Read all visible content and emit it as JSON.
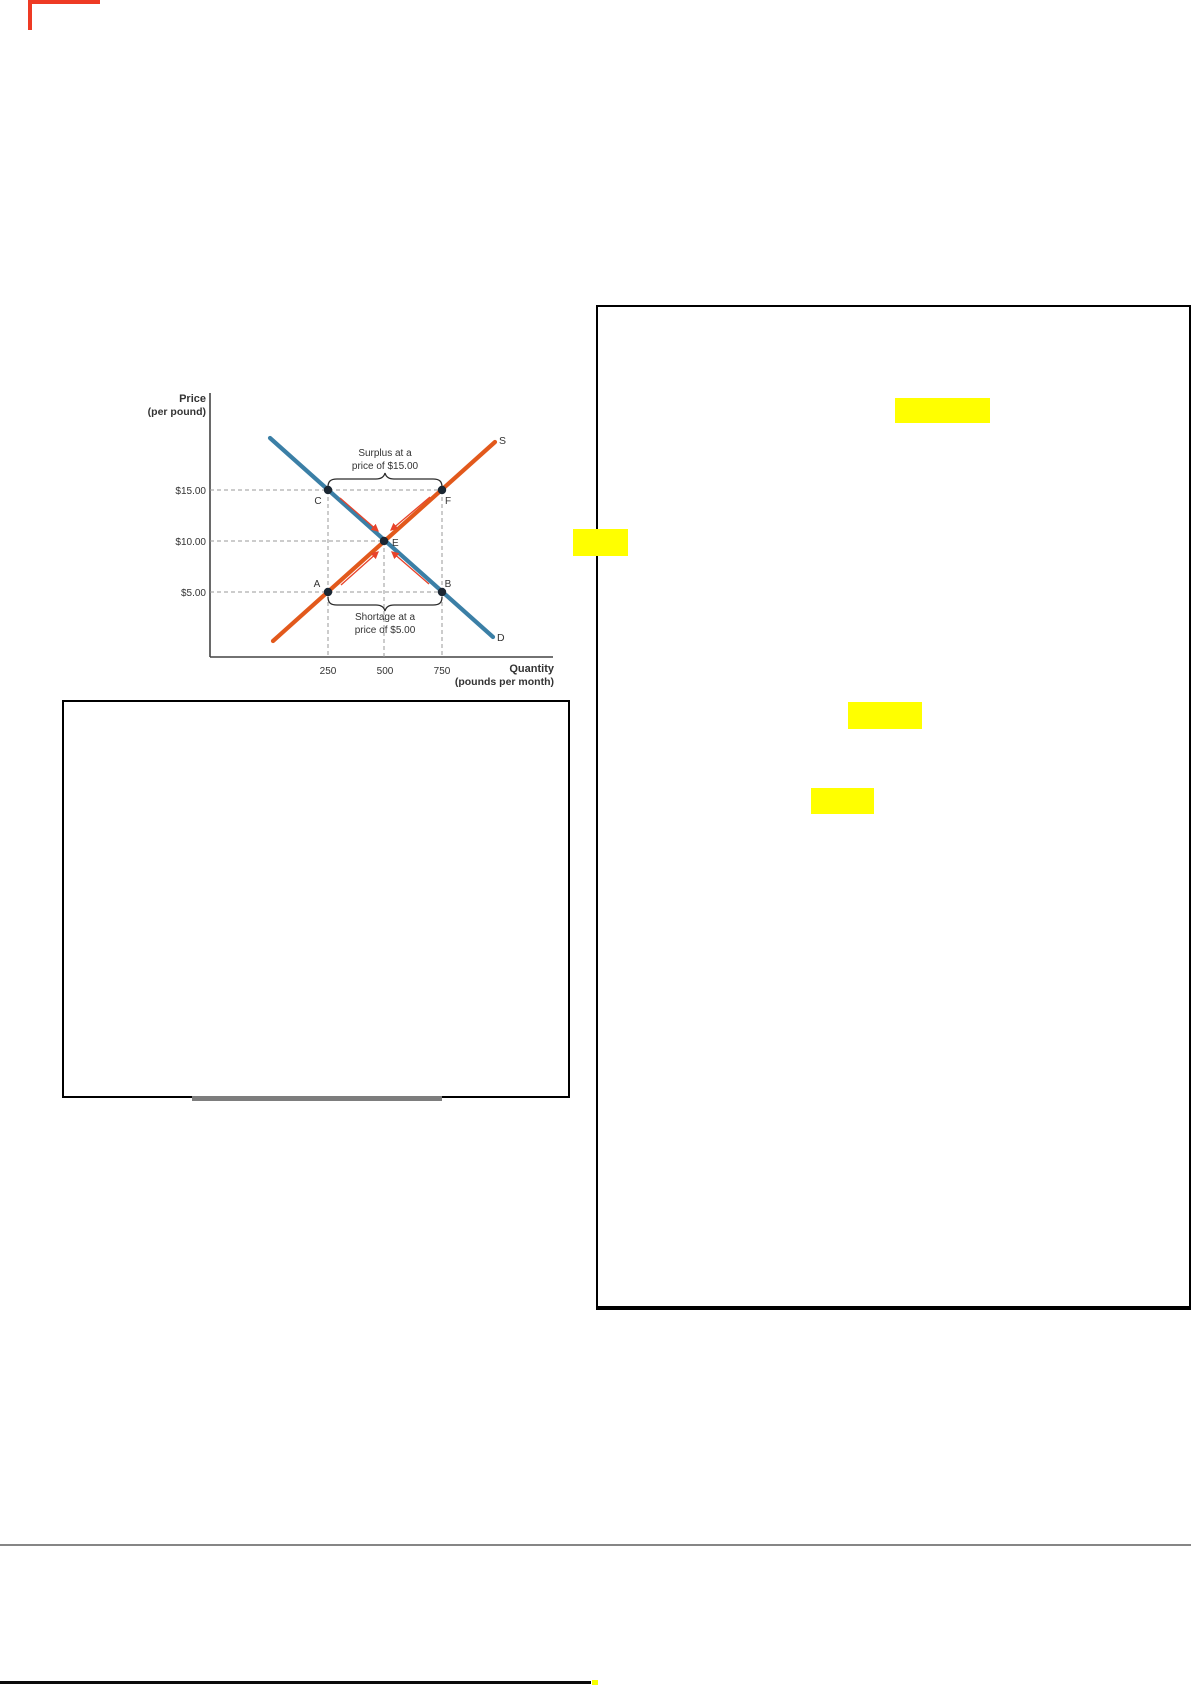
{
  "page": {
    "kind": "scanned economics worksheet page",
    "background": "#ffffff"
  },
  "chart_data": {
    "type": "line",
    "ylabel": "Price (per pound)",
    "ylabel_lines": [
      "Price",
      "(per pound)"
    ],
    "xlabel": "Quantity (pounds per month)",
    "xlabel_lines": [
      "Quantity",
      "(pounds per month)"
    ],
    "y_tick_labels": [
      "$15.00",
      "$10.00",
      "$5.00"
    ],
    "x_tick_labels": [
      "250",
      "500",
      "750"
    ],
    "axis_range_note": "dashed guide lines at each labeled price and quantity",
    "series": [
      {
        "name": "D",
        "role": "demand",
        "color": "#3b7fa6",
        "points_quantity_price": [
          [
            250,
            15
          ],
          [
            500,
            10
          ],
          [
            750,
            5
          ]
        ]
      },
      {
        "name": "S",
        "role": "supply",
        "color": "#e2591c",
        "points_quantity_price": [
          [
            250,
            5
          ],
          [
            500,
            10
          ],
          [
            750,
            15
          ]
        ]
      }
    ],
    "labeled_points": [
      {
        "label": "C",
        "quantity": 250,
        "price": 15
      },
      {
        "label": "F",
        "quantity": 750,
        "price": 15
      },
      {
        "label": "E",
        "quantity": 500,
        "price": 10
      },
      {
        "label": "A",
        "quantity": 250,
        "price": 5
      },
      {
        "label": "B",
        "quantity": 750,
        "price": 5
      }
    ],
    "equilibrium": {
      "price_label": "$10.00",
      "quantity": 500,
      "point": "E"
    },
    "annotations": [
      {
        "text": "Surplus at a price of $15.00",
        "lines": [
          "Surplus at a",
          "price of $15.00"
        ],
        "brace_span": [
          "C",
          "F"
        ]
      },
      {
        "text": "Shortage at a price of $5.00",
        "lines": [
          "Shortage at a",
          "price of $5.00"
        ],
        "brace_span": [
          "A",
          "B"
        ]
      }
    ],
    "arrow_color": "#e8432a",
    "legend_position": "curve-end labels S and D"
  },
  "marks": {
    "red_pen_corner_color": "#ee3a24",
    "highlight_color": "#ffff00",
    "highlight_count": 4,
    "divider_color": "#868686",
    "bottom_rule_color": "#0a0a0a"
  },
  "answer_boxes": {
    "left_box_text": "",
    "right_panel_text": ""
  }
}
